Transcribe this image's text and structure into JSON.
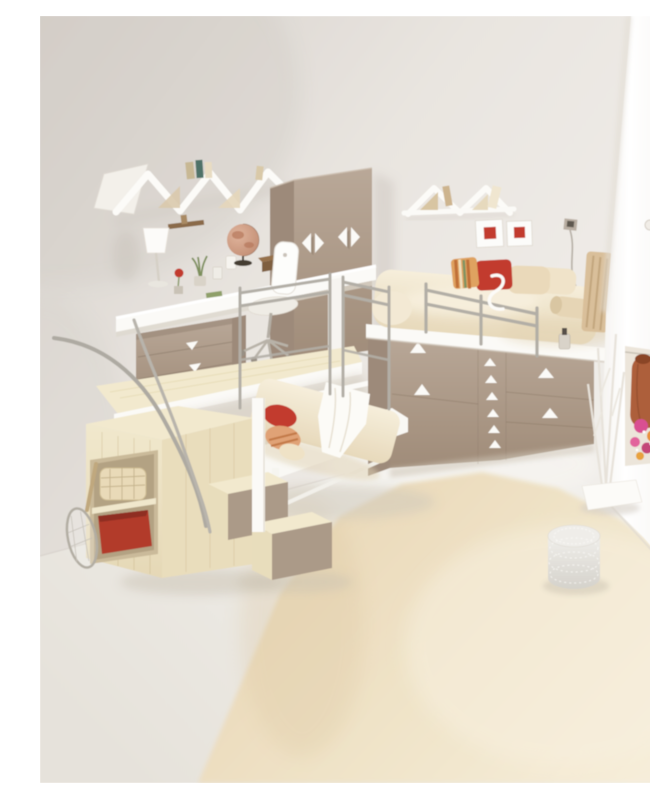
{
  "image": {
    "kind": "photograph",
    "subject": "Teen bedroom interior with an elevated desk platform, loft bed over a chest of drawers, lower bed, wooden stairs and a cream shag rug",
    "render_style": "3D interior visualization, soft daylight",
    "width_px": 650,
    "height_px": 767
  },
  "palette": {
    "wallDark": "#d6d1cb",
    "wallMid": "#e9e5e0",
    "wallLight": "#f2efeb",
    "partitionLight": "#ffffff",
    "partitionShade": "#efece7",
    "floorDark": "#e6e2db",
    "floorLight": "#f2f0ec",
    "rugDark": "#e7d5b3",
    "rugLight": "#f6edd9",
    "woodTop": "#f2e9ce",
    "woodFrontLight": "#f1e8cd",
    "woodFrontDark": "#e5d8b6",
    "woodSide": "#e9ddbc",
    "taupeLight": "#b9a898",
    "taupeMid": "#a89580",
    "taupeDark": "#9d8a7a",
    "stepRiser": "#ab9a88",
    "whiteFurniture": "#fbfaf7",
    "metal": "#b2aea6",
    "red": "#c23b2e",
    "binRed": "#b23a2c",
    "salmon": "#e0a276",
    "stripeOrange": "#c06f38",
    "stripeGreen": "#7e9464",
    "pillowStripeBase": "#dfa261",
    "bedCreamLight": "#f6eedb",
    "bedCreamDark": "#e7d9bb",
    "beigePillow": "#ead9ba",
    "bolster": "#e6d5b5",
    "headboardTan": "#d9bf9a",
    "basket": "#e9dab8",
    "globeLight": "#e0b49c",
    "globeDark": "#bd876d",
    "garment": "#ad5f3a",
    "flowerPink": "#d94f92",
    "flowerMagenta": "#c44778",
    "flowerOrange": "#e8923c",
    "shadow": "#cfc7b8"
  },
  "scene": {
    "objects": [
      "left wall",
      "white partition wall",
      "pale wood floor",
      "cream shag area rug",
      "white zigzag wall shelf with books (left)",
      "white zigzag wall shelf with books (right)",
      "two red framed pictures",
      "wall light with hanging cord",
      "taupe wardrobe with white diamond handles",
      "elevated desk platform with white edge",
      "white desk with lamp, globe, plant and wooden box",
      "white office chair",
      "taupe rolling drawer unit with triangle handles",
      "silver safety railing",
      "curved silver handrail",
      "birch stairs with taupe risers",
      "under-stair cubby with wicker basket and red bin",
      "tennis racket leaning on wall",
      "lower bed with cream bedding, white throw, red and salmon pillows",
      "raised bed on chest of drawers with striped, red and beige pillows, bolster and tan headboard",
      "silver bed guard rail with white S hook",
      "taupe chest of drawers with white triangle handles",
      "open closet niche with colourful hanging clothes",
      "white branch coat stand on white base",
      "woven silver wire pouf on rug",
      "perfume bottle on bed platform"
    ]
  }
}
